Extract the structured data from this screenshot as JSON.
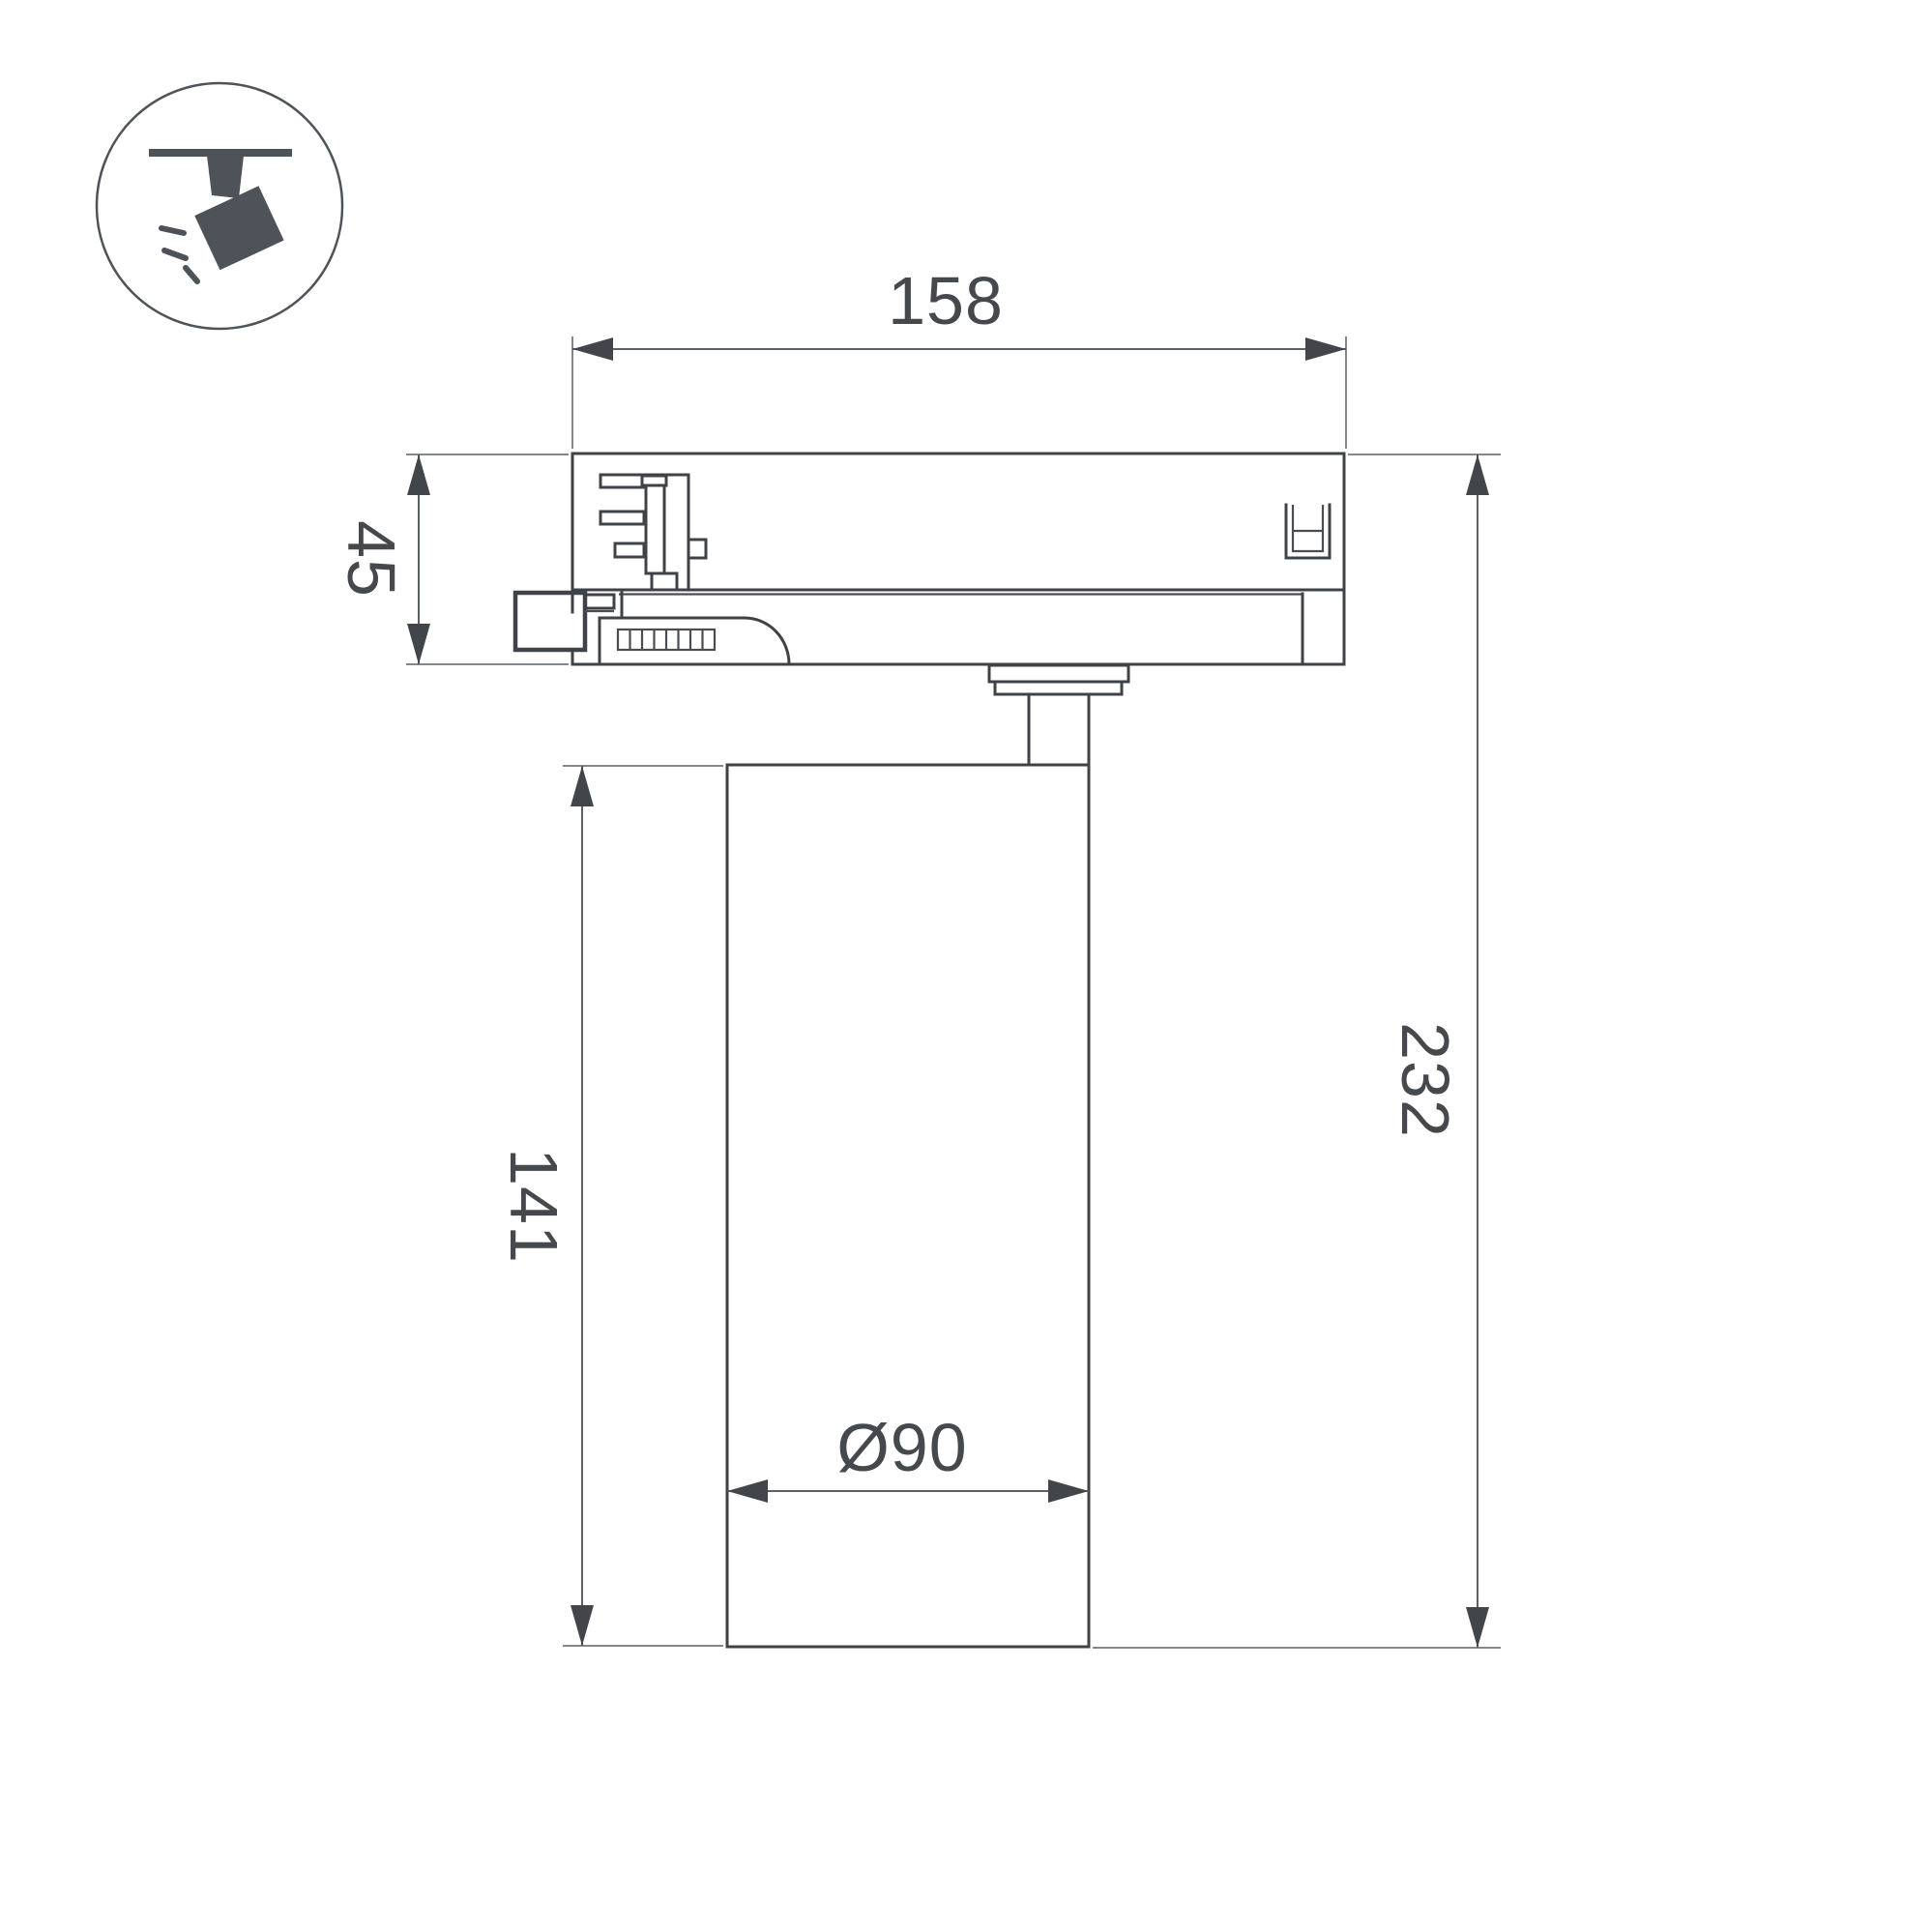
{
  "drawing": {
    "dim_width": "158",
    "dim_adapter_height": "45",
    "dim_body_height": "141",
    "dim_total_height": "232",
    "dim_diameter": "Ø90"
  },
  "icon": {
    "type": "track-spotlight-icon"
  },
  "colors": {
    "line": "#3f4347",
    "dimension_line": "#5d6166",
    "extension_line": "#84878b",
    "text": "#45494d",
    "icon": "#4d5359",
    "background": "#ffffff"
  }
}
